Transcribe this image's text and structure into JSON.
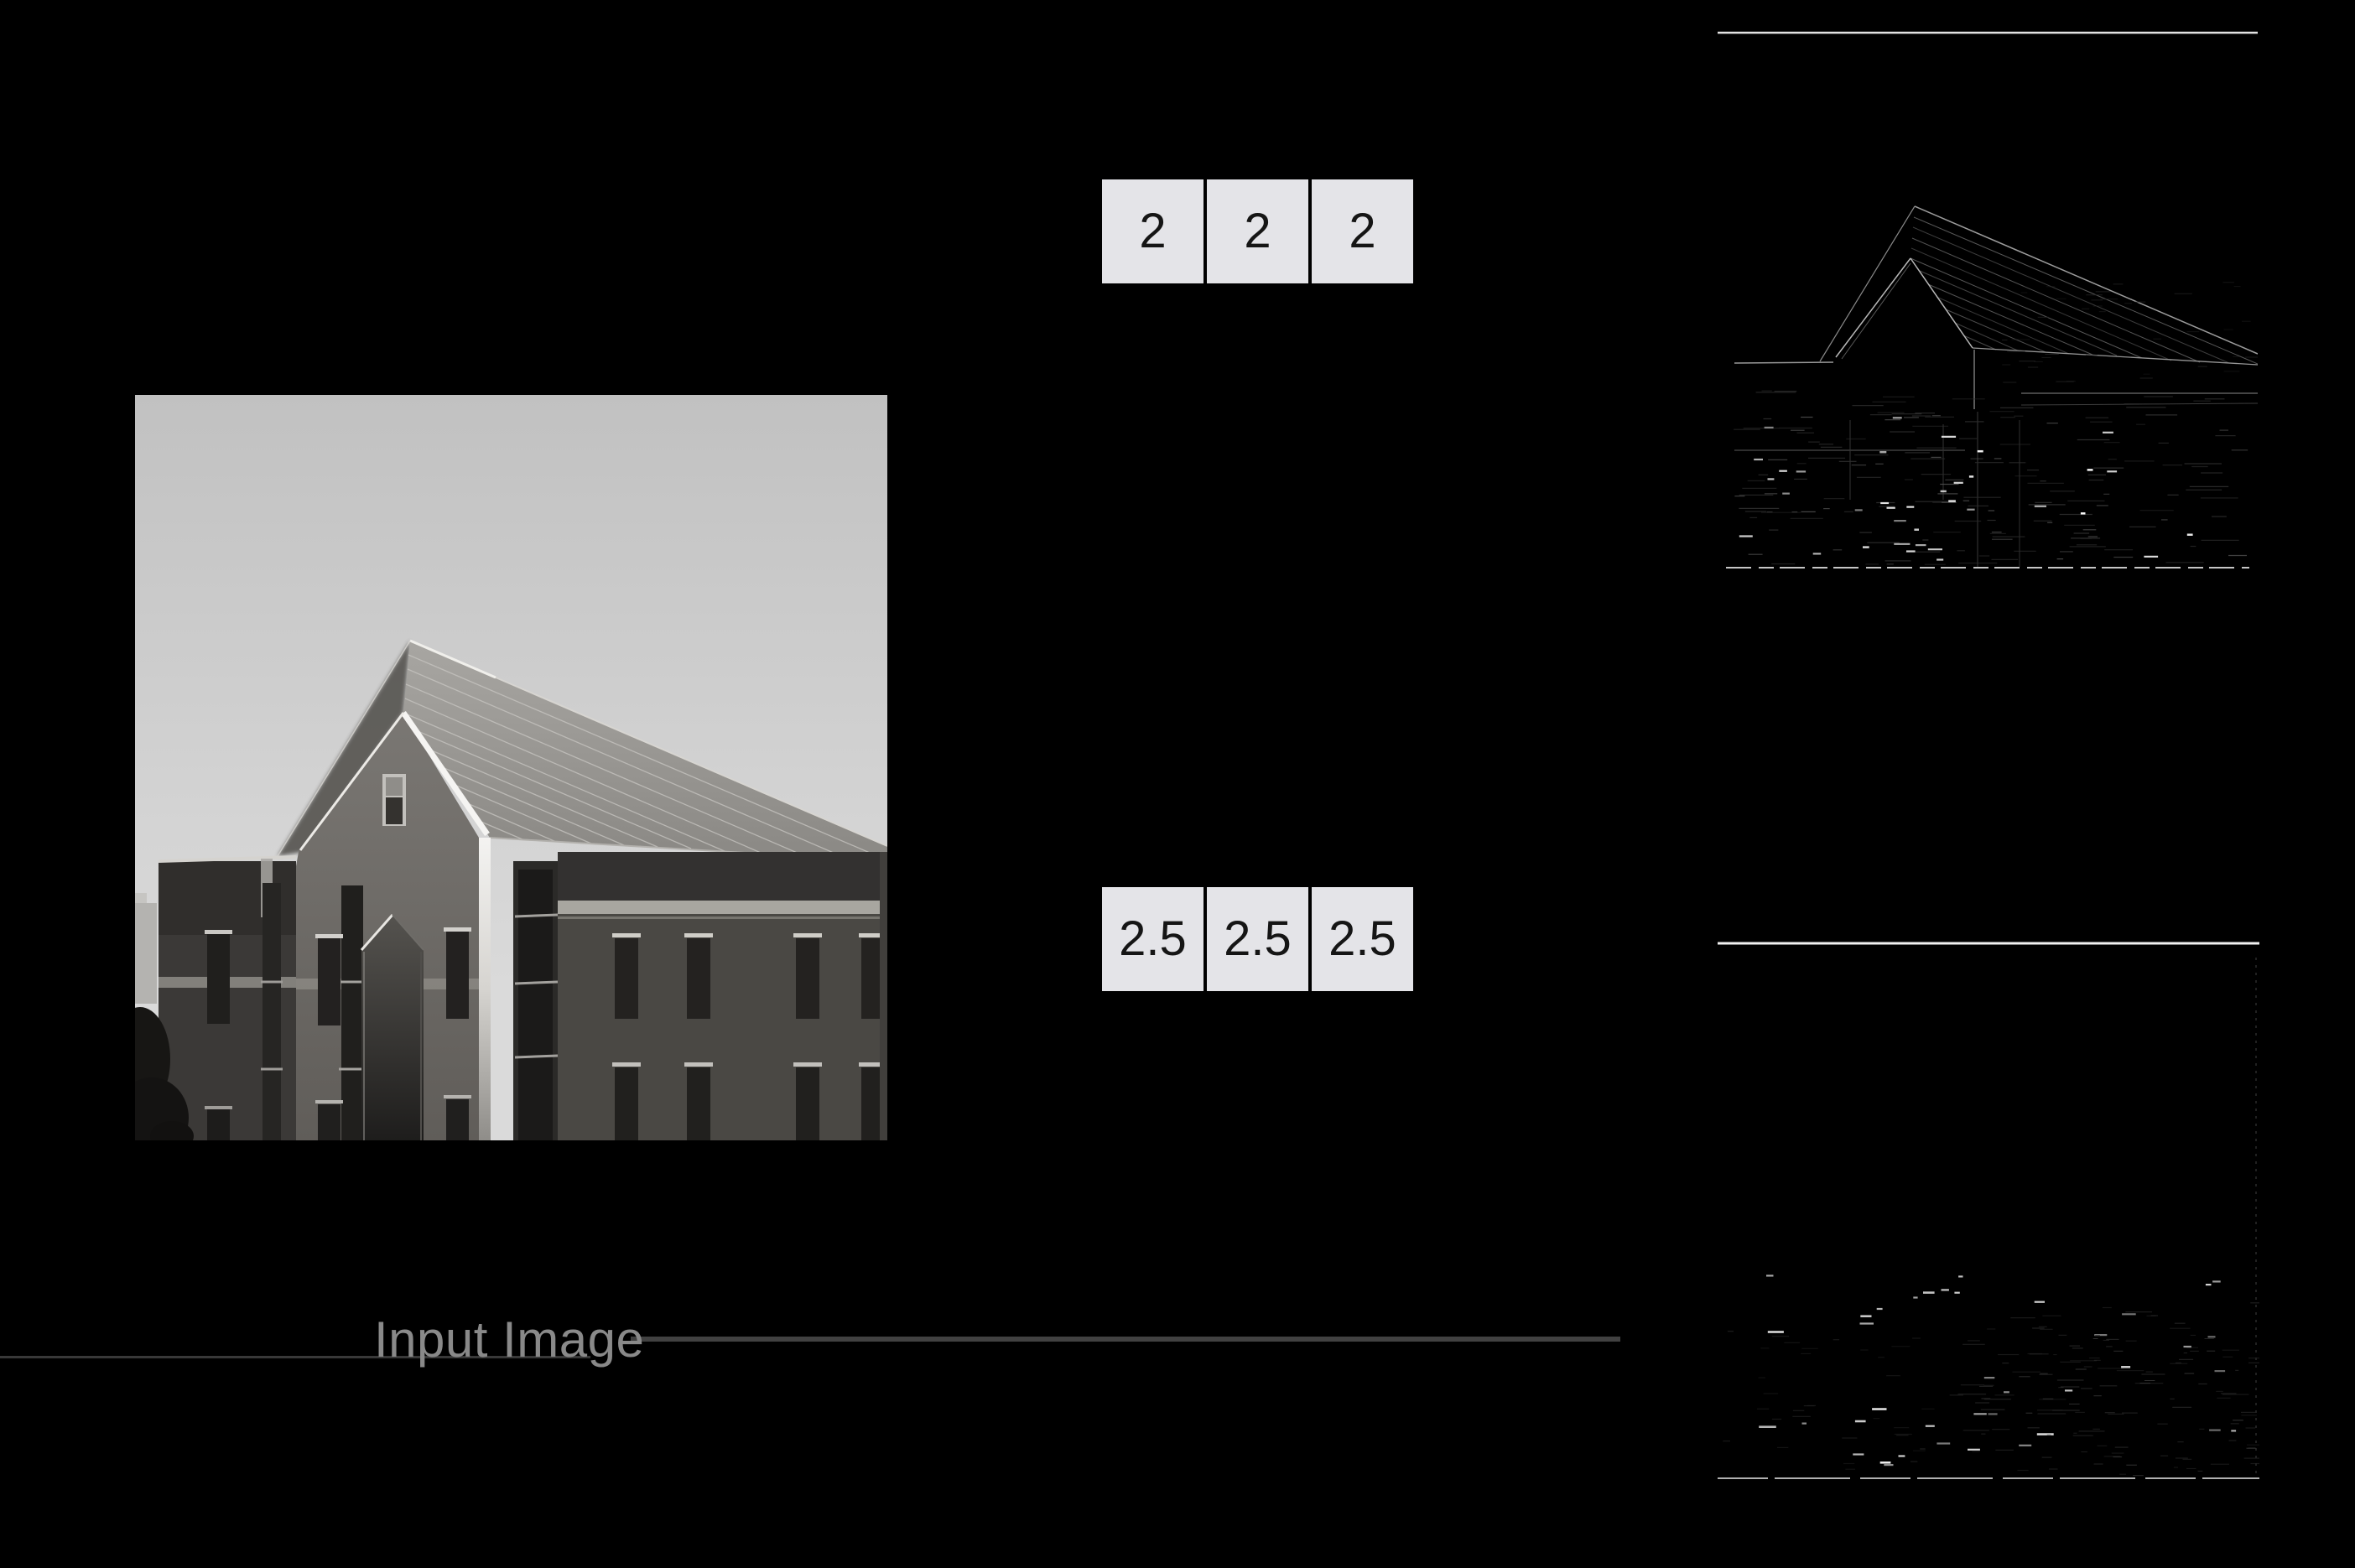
{
  "figure": {
    "background": "#000000",
    "description": "Convolution figure: grayscale building input image, two 1x3 kernels, and two edge-response output images on black background"
  },
  "input_image": {
    "label": "Input Image",
    "label_color": "#898989",
    "content": "grayscale photo of brick building with gabled roof against light sky"
  },
  "kernel_top": {
    "cells": [
      "2",
      "2",
      "2"
    ]
  },
  "kernel_bottom": {
    "cells": [
      "2.5",
      "2.5",
      "2.5"
    ]
  },
  "kernel_style": {
    "cell_background": "#e4e4e8",
    "cell_text_color": "#151515"
  },
  "connectors": {
    "label_underline_color": "#383838",
    "label_to_output_line_color": "#414141"
  },
  "output_top": {
    "top_edge_line_color": "#e2e2e2",
    "content": "edge-filtered building image, faint gray roof lines and bright dashes on black",
    "noise_layers": [
      {
        "seed": 11,
        "count": 110,
        "x": [
          12,
          600
        ],
        "y": [
          430,
          638
        ],
        "len": [
          10,
          48
        ],
        "color": "#2d2d2d",
        "width": 1.2,
        "opacity": [
          0.5,
          1
        ]
      },
      {
        "seed": 23,
        "count": 60,
        "x": [
          12,
          615
        ],
        "y": [
          450,
          638
        ],
        "len": [
          6,
          26
        ],
        "color": "#4f4f4f",
        "width": 1.2,
        "opacity": [
          0.4,
          0.9
        ]
      },
      {
        "seed": 37,
        "count": 26,
        "x": [
          18,
          600
        ],
        "y": [
          462,
          636
        ],
        "len": [
          7,
          20
        ],
        "color": "#e6e6e6",
        "width": 2.2,
        "opacity": [
          0.5,
          1
        ]
      },
      {
        "seed": 51,
        "count": 10,
        "x": [
          40,
          560
        ],
        "y": [
          490,
          630
        ],
        "len": [
          4,
          9
        ],
        "color": "#ffffff",
        "width": 2.5,
        "opacity": [
          0.65,
          1
        ]
      },
      {
        "seed": 63,
        "count": 40,
        "x": [
          320,
          640
        ],
        "y": [
          300,
          420
        ],
        "len": [
          6,
          22
        ],
        "color": "#222222",
        "width": 1.0,
        "opacity": [
          0.4,
          0.9
        ]
      }
    ]
  },
  "output_bottom": {
    "top_edge_line_color": "#f2f2f2",
    "content": "mostly black filtered image with scattered bright dashes near the bottom",
    "noise_layers": [
      {
        "seed": 5,
        "count": 90,
        "x": [
          285,
          640
        ],
        "y": [
          430,
          636
        ],
        "len": [
          8,
          34
        ],
        "color": "#232323",
        "width": 1.2,
        "opacity": [
          0.5,
          1
        ]
      },
      {
        "seed": 17,
        "count": 34,
        "x": [
          4,
          280
        ],
        "y": [
          460,
          636
        ],
        "len": [
          6,
          22
        ],
        "color": "#1e1e1e",
        "width": 1.2,
        "opacity": [
          0.5,
          1
        ]
      },
      {
        "seed": 29,
        "count": 30,
        "x": [
          8,
          628
        ],
        "y": [
          398,
          634
        ],
        "len": [
          5,
          17
        ],
        "color": "#d6d6d6",
        "width": 2.2,
        "opacity": [
          0.45,
          1
        ]
      },
      {
        "seed": 43,
        "count": 9,
        "x": [
          25,
          600
        ],
        "y": [
          408,
          630
        ],
        "len": [
          10,
          22
        ],
        "color": "#ffffff",
        "width": 2.6,
        "opacity": [
          0.7,
          1
        ]
      },
      {
        "seed": 57,
        "count": 50,
        "x": [
          300,
          640
        ],
        "y": [
          470,
          640
        ],
        "len": [
          4,
          14
        ],
        "color": "#3a3a3a",
        "width": 1.0,
        "opacity": [
          0.4,
          0.9
        ]
      }
    ]
  }
}
